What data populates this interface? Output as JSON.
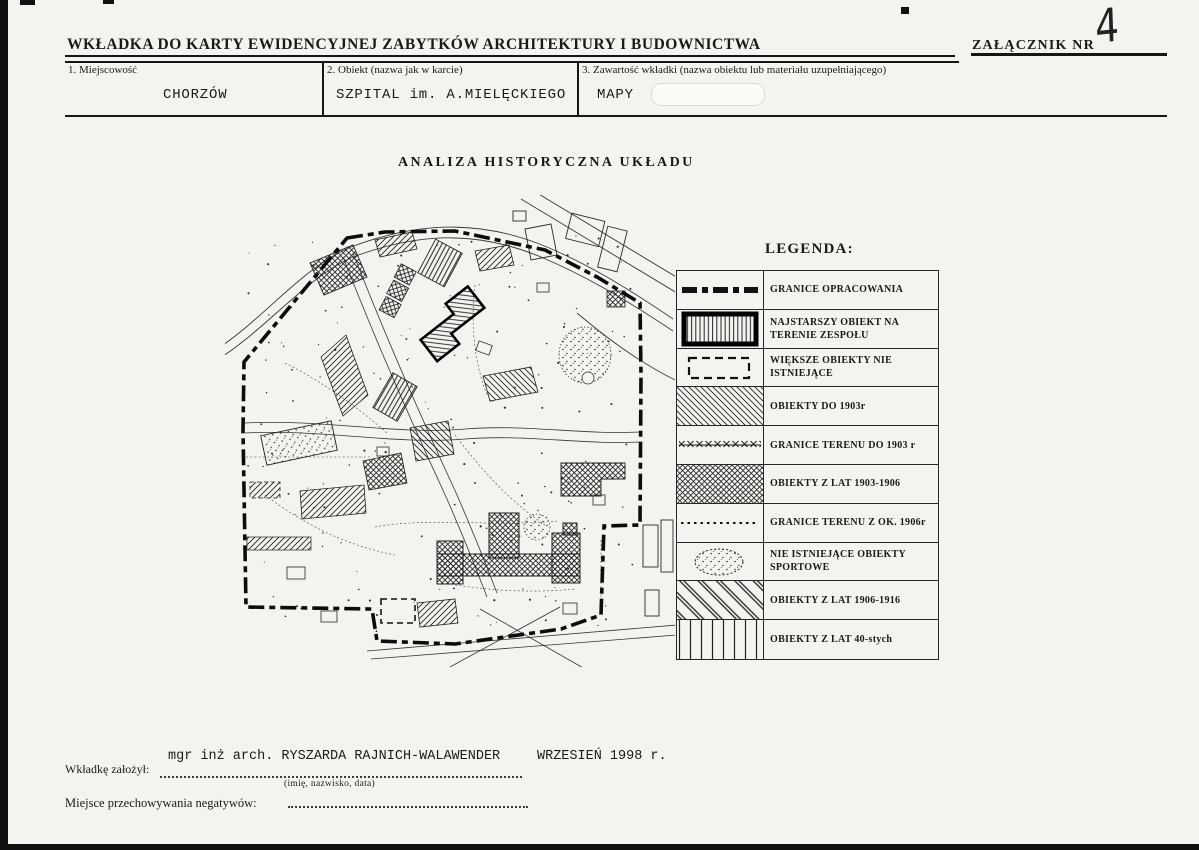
{
  "page": {
    "background": "#f4f3ef",
    "ink": "#1a1a1a",
    "title": "WKŁADKA DO KARTY EWIDENCYJNEJ ZABYTKÓW ARCHITEKTURY I BUDOWNICTWA",
    "attachment_label": "ZAŁĄCZNIK NR",
    "attachment_number": "4"
  },
  "form": {
    "fields": [
      {
        "label": "1. Miejscowość",
        "value": "CHORZÓW"
      },
      {
        "label": "2. Obiekt (nazwa jak w karcie)",
        "value": "SZPITAL im. A.MIELĘCKIEGO"
      },
      {
        "label": "3. Zawartość wkładki (nazwa obiektu lub materiału uzupełniającego)",
        "value": "MAPY"
      }
    ]
  },
  "map": {
    "title": "ANALIZA HISTORYCZNA UKŁADU"
  },
  "legend": {
    "title": "LEGENDA:",
    "items": [
      {
        "symbol": "boundary-line",
        "label": "GRANICE OPRACOWANIA"
      },
      {
        "symbol": "oldest-building",
        "label": "NAJSTARSZY OBIEKT NA TERENIE ZESPOŁU"
      },
      {
        "symbol": "dashed-outline",
        "label": "WIĘKSZE OBIEKTY NIE ISTNIEJĄCE"
      },
      {
        "symbol": "diagonal-hatch",
        "label": "OBIEKTY DO 1903r"
      },
      {
        "symbol": "x-marked-line",
        "label": "GRANICE TERENU DO 1903 r"
      },
      {
        "symbol": "crosshatch",
        "label": "OBIEKTY Z LAT 1903-1906"
      },
      {
        "symbol": "dotted-line",
        "label": "GRANICE TERENU Z OK. 1906r"
      },
      {
        "symbol": "stippled-oval",
        "label": "NIE ISTNIEJĄCE OBIEKTY SPORTOWE"
      },
      {
        "symbol": "wide-diagonal-stripes",
        "label": "OBIEKTY Z LAT 1906-1916"
      },
      {
        "symbol": "vertical-stripes",
        "label": "OBIEKTY Z LAT 40-stych"
      }
    ]
  },
  "footer": {
    "prepared_by_label": "Wkładkę założył:",
    "prepared_by_value": "mgr inż arch. RYSZARDA RAJNICH-WALAWENDER",
    "prepared_date": "WRZESIEŃ  1998 r.",
    "name_hint": "(imię, nazwisko, data)",
    "negatives_label": "Miejsce przechowywania negatywów:"
  }
}
